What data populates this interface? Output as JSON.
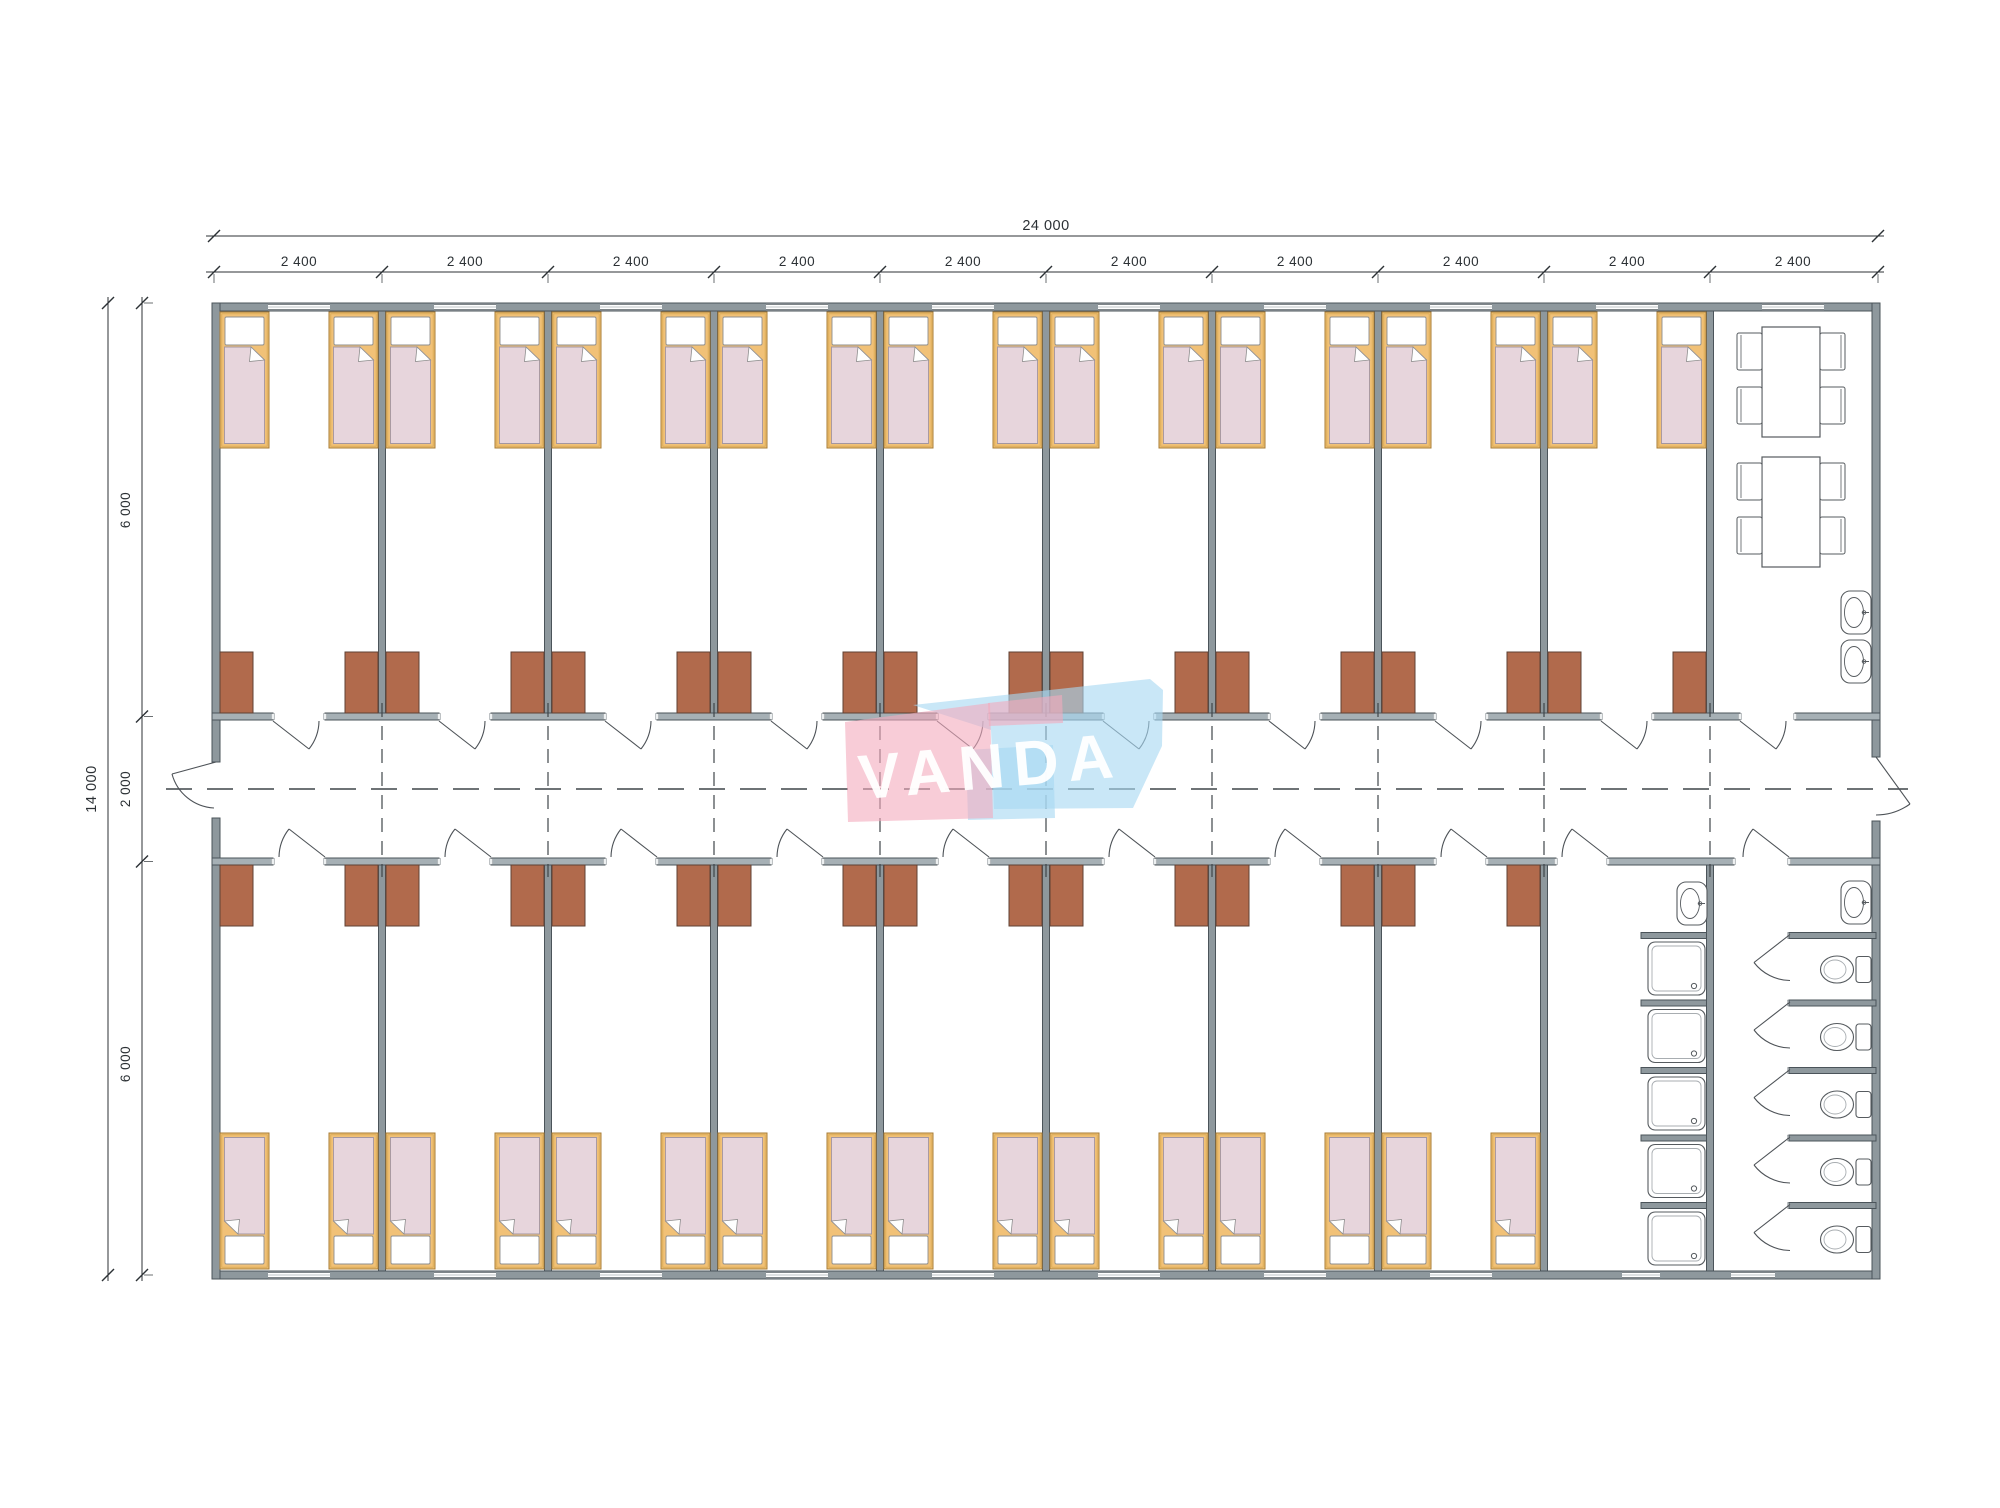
{
  "watermark": {
    "text": "VANDA"
  },
  "dimensions": {
    "top_total": "24 000",
    "top_segments": [
      "2 400",
      "2 400",
      "2 400",
      "2 400",
      "2 400",
      "2 400",
      "2 400",
      "2 400",
      "2 400",
      "2 400"
    ],
    "left_total": "14 000",
    "left_segments": [
      "6 000",
      "2 000",
      "6 000"
    ]
  },
  "colors": {
    "wall_fill": "#8e989d",
    "wall_stroke": "#4b545a",
    "corridor_wall_fill": "#a6b0b5",
    "jamb_fill": "#edf0f1",
    "line": "#4d5257",
    "bed_frame": "#f1c177",
    "bed_frame_stroke": "#a87d36",
    "blanket": "#e7d5dc",
    "blanket_stroke": "#a396a0",
    "pillow": "#ffffff",
    "pillow_stroke": "#8f8f8f",
    "wardrobe": "#b16a4c",
    "wardrobe_stroke": "#5f4134",
    "fixture_stroke": "#565b5f",
    "fixture_inner_stroke": "#a8adb1",
    "dashed": "#3f4549",
    "dim": "#2c3135",
    "watermark_pink": "rgba(244,170,188,0.60)",
    "watermark_blue": "rgba(168,216,242,0.62)",
    "watermark_text": "rgba(255,255,255,0.95)"
  },
  "inventory": {
    "bedrooms_top_row": 9,
    "bedrooms_bottom_row": 8,
    "beds": 34,
    "wardrobes": 34,
    "dining_tables": 2,
    "dining_chairs": 8,
    "washbasins": 4,
    "showers": 5,
    "toilets": 5,
    "exterior_doors": 2
  }
}
